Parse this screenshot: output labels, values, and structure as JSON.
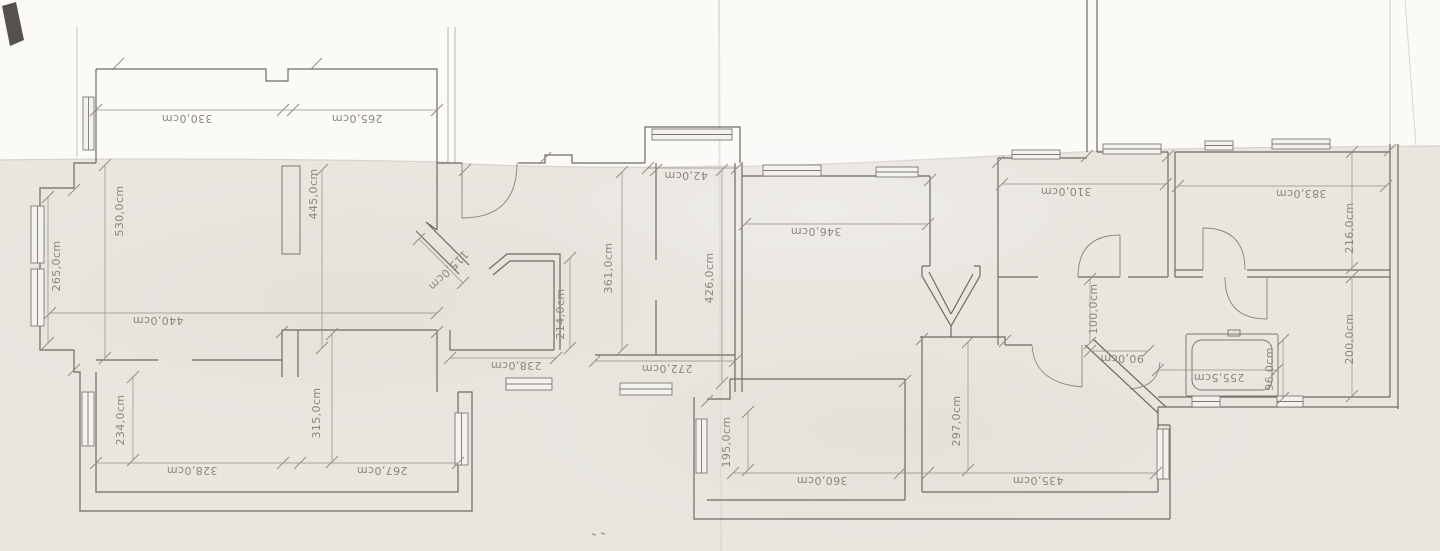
{
  "document": {
    "kind": "scanned-floor-plan",
    "units": "cm"
  },
  "colors": {
    "paper_top": "#fbfaf7",
    "paper_bottom": "#e9e6e0",
    "wall_ink": "#6e6a62",
    "dimension_ink": "#938f84",
    "label_ink": "#8b877c"
  },
  "dimension_labels": [
    {
      "text": "330,0cm",
      "x": 187,
      "y": 118,
      "rot": 180
    },
    {
      "text": "265,0cm",
      "x": 357,
      "y": 118,
      "rot": 180
    },
    {
      "text": "440,0cm",
      "x": 158,
      "y": 320,
      "rot": 180
    },
    {
      "text": "328,0cm",
      "x": 192,
      "y": 470,
      "rot": 180
    },
    {
      "text": "267,0cm",
      "x": 382,
      "y": 470,
      "rot": 180
    },
    {
      "text": "238,0cm",
      "x": 516,
      "y": 365,
      "rot": 180
    },
    {
      "text": "272,0cm",
      "x": 667,
      "y": 368,
      "rot": 180
    },
    {
      "text": "42,0cm",
      "x": 686,
      "y": 175,
      "rot": 180
    },
    {
      "text": "346,0cm",
      "x": 816,
      "y": 231,
      "rot": 180
    },
    {
      "text": "310,0cm",
      "x": 1066,
      "y": 191,
      "rot": 180
    },
    {
      "text": "383,0cm",
      "x": 1301,
      "y": 193,
      "rot": 180
    },
    {
      "text": "90,0cm",
      "x": 1122,
      "y": 358,
      "rot": 180
    },
    {
      "text": "255,5cm",
      "x": 1219,
      "y": 377,
      "rot": 180
    },
    {
      "text": "360,0cm",
      "x": 822,
      "y": 480,
      "rot": 180
    },
    {
      "text": "435,0cm",
      "x": 1038,
      "y": 480,
      "rot": 180
    },
    {
      "text": "265,0cm",
      "x": 57,
      "y": 266,
      "rot": -90
    },
    {
      "text": "530,0cm",
      "x": 120,
      "y": 211,
      "rot": -90
    },
    {
      "text": "445,0cm",
      "x": 314,
      "y": 194,
      "rot": -90
    },
    {
      "text": "234,0cm",
      "x": 121,
      "y": 420,
      "rot": -90
    },
    {
      "text": "315,0cm",
      "x": 317,
      "y": 413,
      "rot": -90
    },
    {
      "text": "214,0cm",
      "x": 561,
      "y": 314,
      "rot": -90
    },
    {
      "text": "361,0cm",
      "x": 609,
      "y": 268,
      "rot": -90
    },
    {
      "text": "426,0cm",
      "x": 710,
      "y": 278,
      "rot": -90
    },
    {
      "text": "195,0cm",
      "x": 727,
      "y": 442,
      "rot": -90
    },
    {
      "text": "297,0cm",
      "x": 957,
      "y": 421,
      "rot": -90
    },
    {
      "text": "100,0cm",
      "x": 1094,
      "y": 309,
      "rot": -90
    },
    {
      "text": "96,0cm",
      "x": 1270,
      "y": 369,
      "rot": -90
    },
    {
      "text": "216,0cm",
      "x": 1350,
      "y": 228,
      "rot": -90
    },
    {
      "text": "200,0cm",
      "x": 1350,
      "y": 339,
      "rot": -90
    },
    {
      "text": "115,0cm",
      "x": 448,
      "y": 270,
      "rot": 135
    }
  ]
}
